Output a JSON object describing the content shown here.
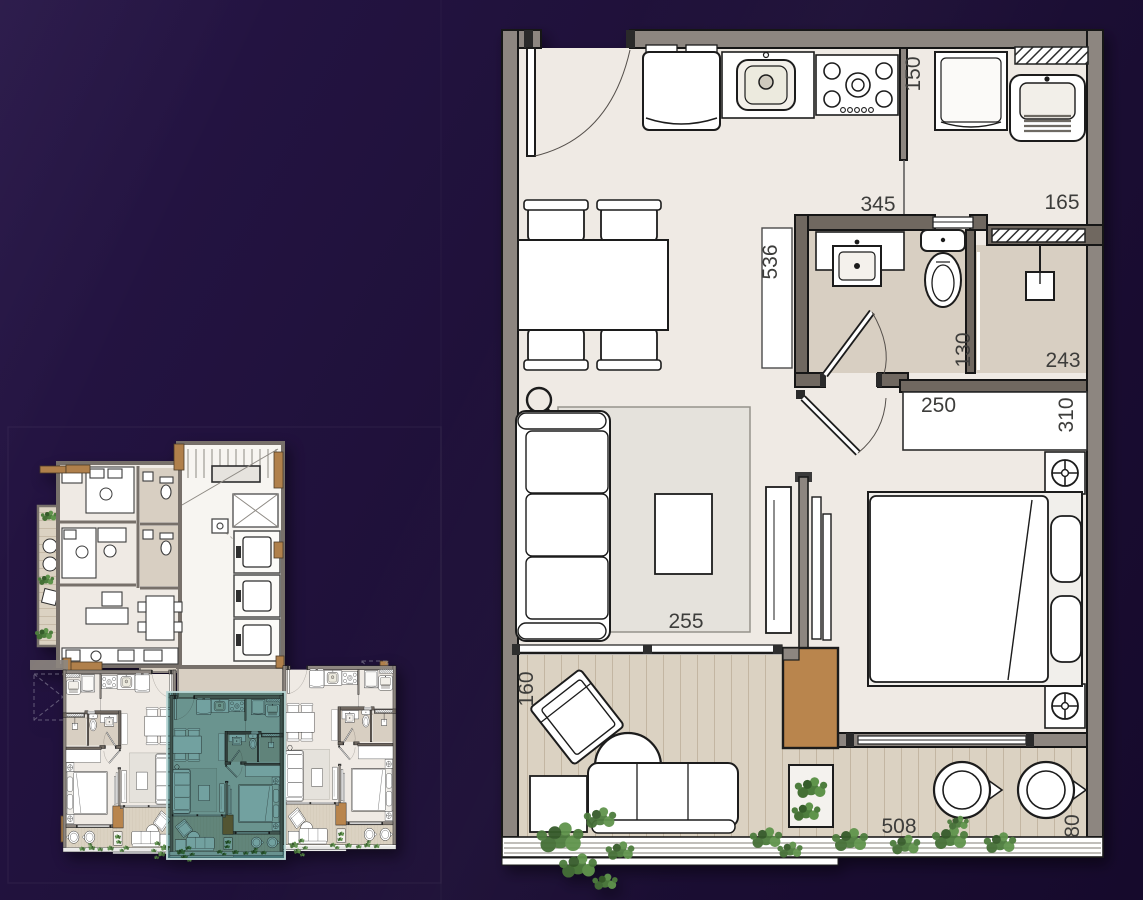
{
  "scene": {
    "type": "apartment floor plan presentation",
    "background_top": "#261546",
    "background_bottom": "#160a2c"
  },
  "unit_plan": {
    "label": "enlarged unit floor plan",
    "dims": {
      "kitchen_pass": "150",
      "hall": "345",
      "service": "165",
      "living_len": "536",
      "bath": "130",
      "shower": "243",
      "wardrobe": "250",
      "bedroom": "310",
      "living_w": "255",
      "balcony_depth": "160",
      "balcony_len": "508",
      "balcony_end": "80"
    },
    "colors": {
      "floor": "#efeae4",
      "wet_floor": "#d8cfc2",
      "deck": "#dbd2c2",
      "wall": "#8d8680",
      "wet_wall": "#6f6761",
      "wood": "#b9854e",
      "rug": "#e5e2dc",
      "plant": "#55813f"
    }
  },
  "key_plan": {
    "label": "floor key plan",
    "highlighted_unit": "center bottom unit",
    "highlight_color": "#4f8a88"
  }
}
